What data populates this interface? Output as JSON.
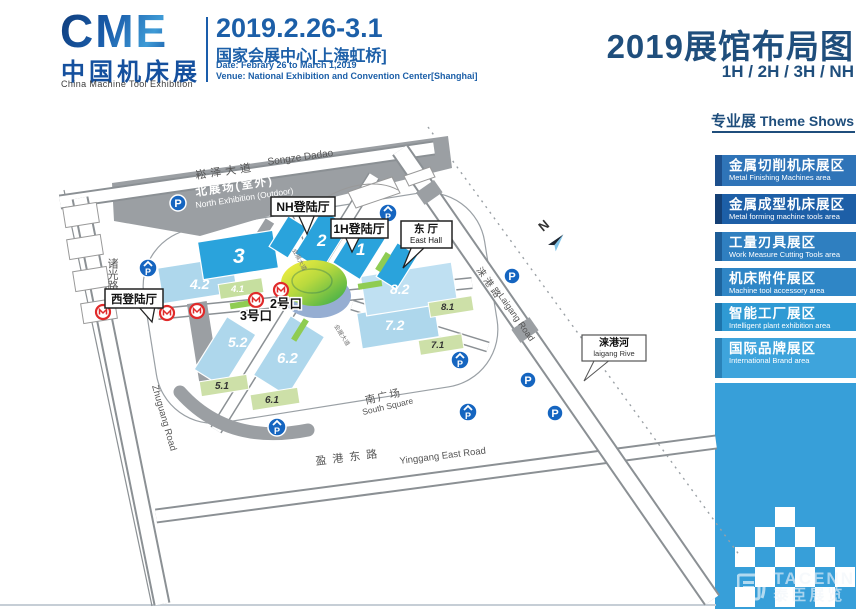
{
  "header": {
    "logo": {
      "word": "CME",
      "cn": "中国机床展",
      "en": "China Machine Tool Exhibition"
    },
    "date_range": "2019.2.26-3.1",
    "venue_cn": "国家会展中心[上海虹桥]",
    "date_line": "Date:  Febrary 26 to March 1,2019",
    "venue_line": "Venue:  National Exhibition and Convention Center[Shanghai]",
    "title": "2019展馆布局图",
    "subtitle": "1H / 2H / 3H / NH"
  },
  "sidebar": {
    "heading_cn": "专业展",
    "heading_en": " Theme Shows",
    "items": [
      {
        "cn": "金属切削机床展区",
        "en": "Metal Finishing Machines area",
        "color": "#2f74b8"
      },
      {
        "cn": "金属成型机床展区",
        "en": "Metal forming machine tools area",
        "color": "#1d5fa7"
      },
      {
        "cn": "工量刃具展区",
        "en": "Work Measure Cutting Tools area",
        "color": "#2f7fc0"
      },
      {
        "cn": "机床附件展区",
        "en": "Machine tool accessory area",
        "color": "#2f86c6"
      },
      {
        "cn": "智能工厂展区",
        "en": "Intelligent plant exhibition area",
        "color": "#2f9ad4"
      },
      {
        "cn": "国际品牌展区",
        "en": "International Brand area",
        "color": "#3ea4dc"
      }
    ]
  },
  "map": {
    "labels": {
      "songze_cn": "崧泽大道",
      "songze_en": "Songze Dadao",
      "north_zone_cn": "北展场(室外)",
      "north_zone_en": "North Exhibition (Outdoor)",
      "zhuguang_cn": "诸光路",
      "zhuguang_en": "Zhuguang Road",
      "yinggang_cn": "盈港东路",
      "yinggang_en": "Yinggang East Road",
      "laigang_cn": "涞港路",
      "laigang_en": "Laigang Road",
      "river_cn": "涞港河",
      "river_en": "laigang Rive",
      "south_square_cn": "南广场",
      "south_square_en": "South Square",
      "east_hall_cn": "东 厅",
      "east_hall_en": "East Hall",
      "nh_lobby": "NH登陆厅",
      "h1_lobby": "1H登陆厅",
      "west_lobby": "西登陆厅",
      "gate2": "2号口",
      "gate3": "3号口",
      "expo_ave": "会展大道",
      "north": "N"
    },
    "halls": {
      "h1": "1",
      "h2": "2",
      "h3": "3",
      "h41": "4.1",
      "h42": "4.2",
      "h51": "5.1",
      "h52": "5.2",
      "h61": "6.1",
      "h62": "6.2",
      "h71": "7.1",
      "h72": "7.2",
      "h81": "8.1",
      "h82": "8.2"
    },
    "colors": {
      "dark_hall": "#2aa3dc",
      "light_hall": "#aed7ec",
      "pale_hall": "#bfe0f2",
      "green_hall": "#cde0a8",
      "median_green": "#8fcc52",
      "dome_yellow": "#f8ef3e",
      "dome_green": "#2fa84a",
      "zone_gray": "#9b9fa3",
      "metro_red": "#e02a2a",
      "parking_blue": "#1565c0"
    }
  },
  "icons": {
    "parking": "P"
  },
  "watermark": {
    "logo_text": "TACENN",
    "cn": "泰臣展览"
  }
}
